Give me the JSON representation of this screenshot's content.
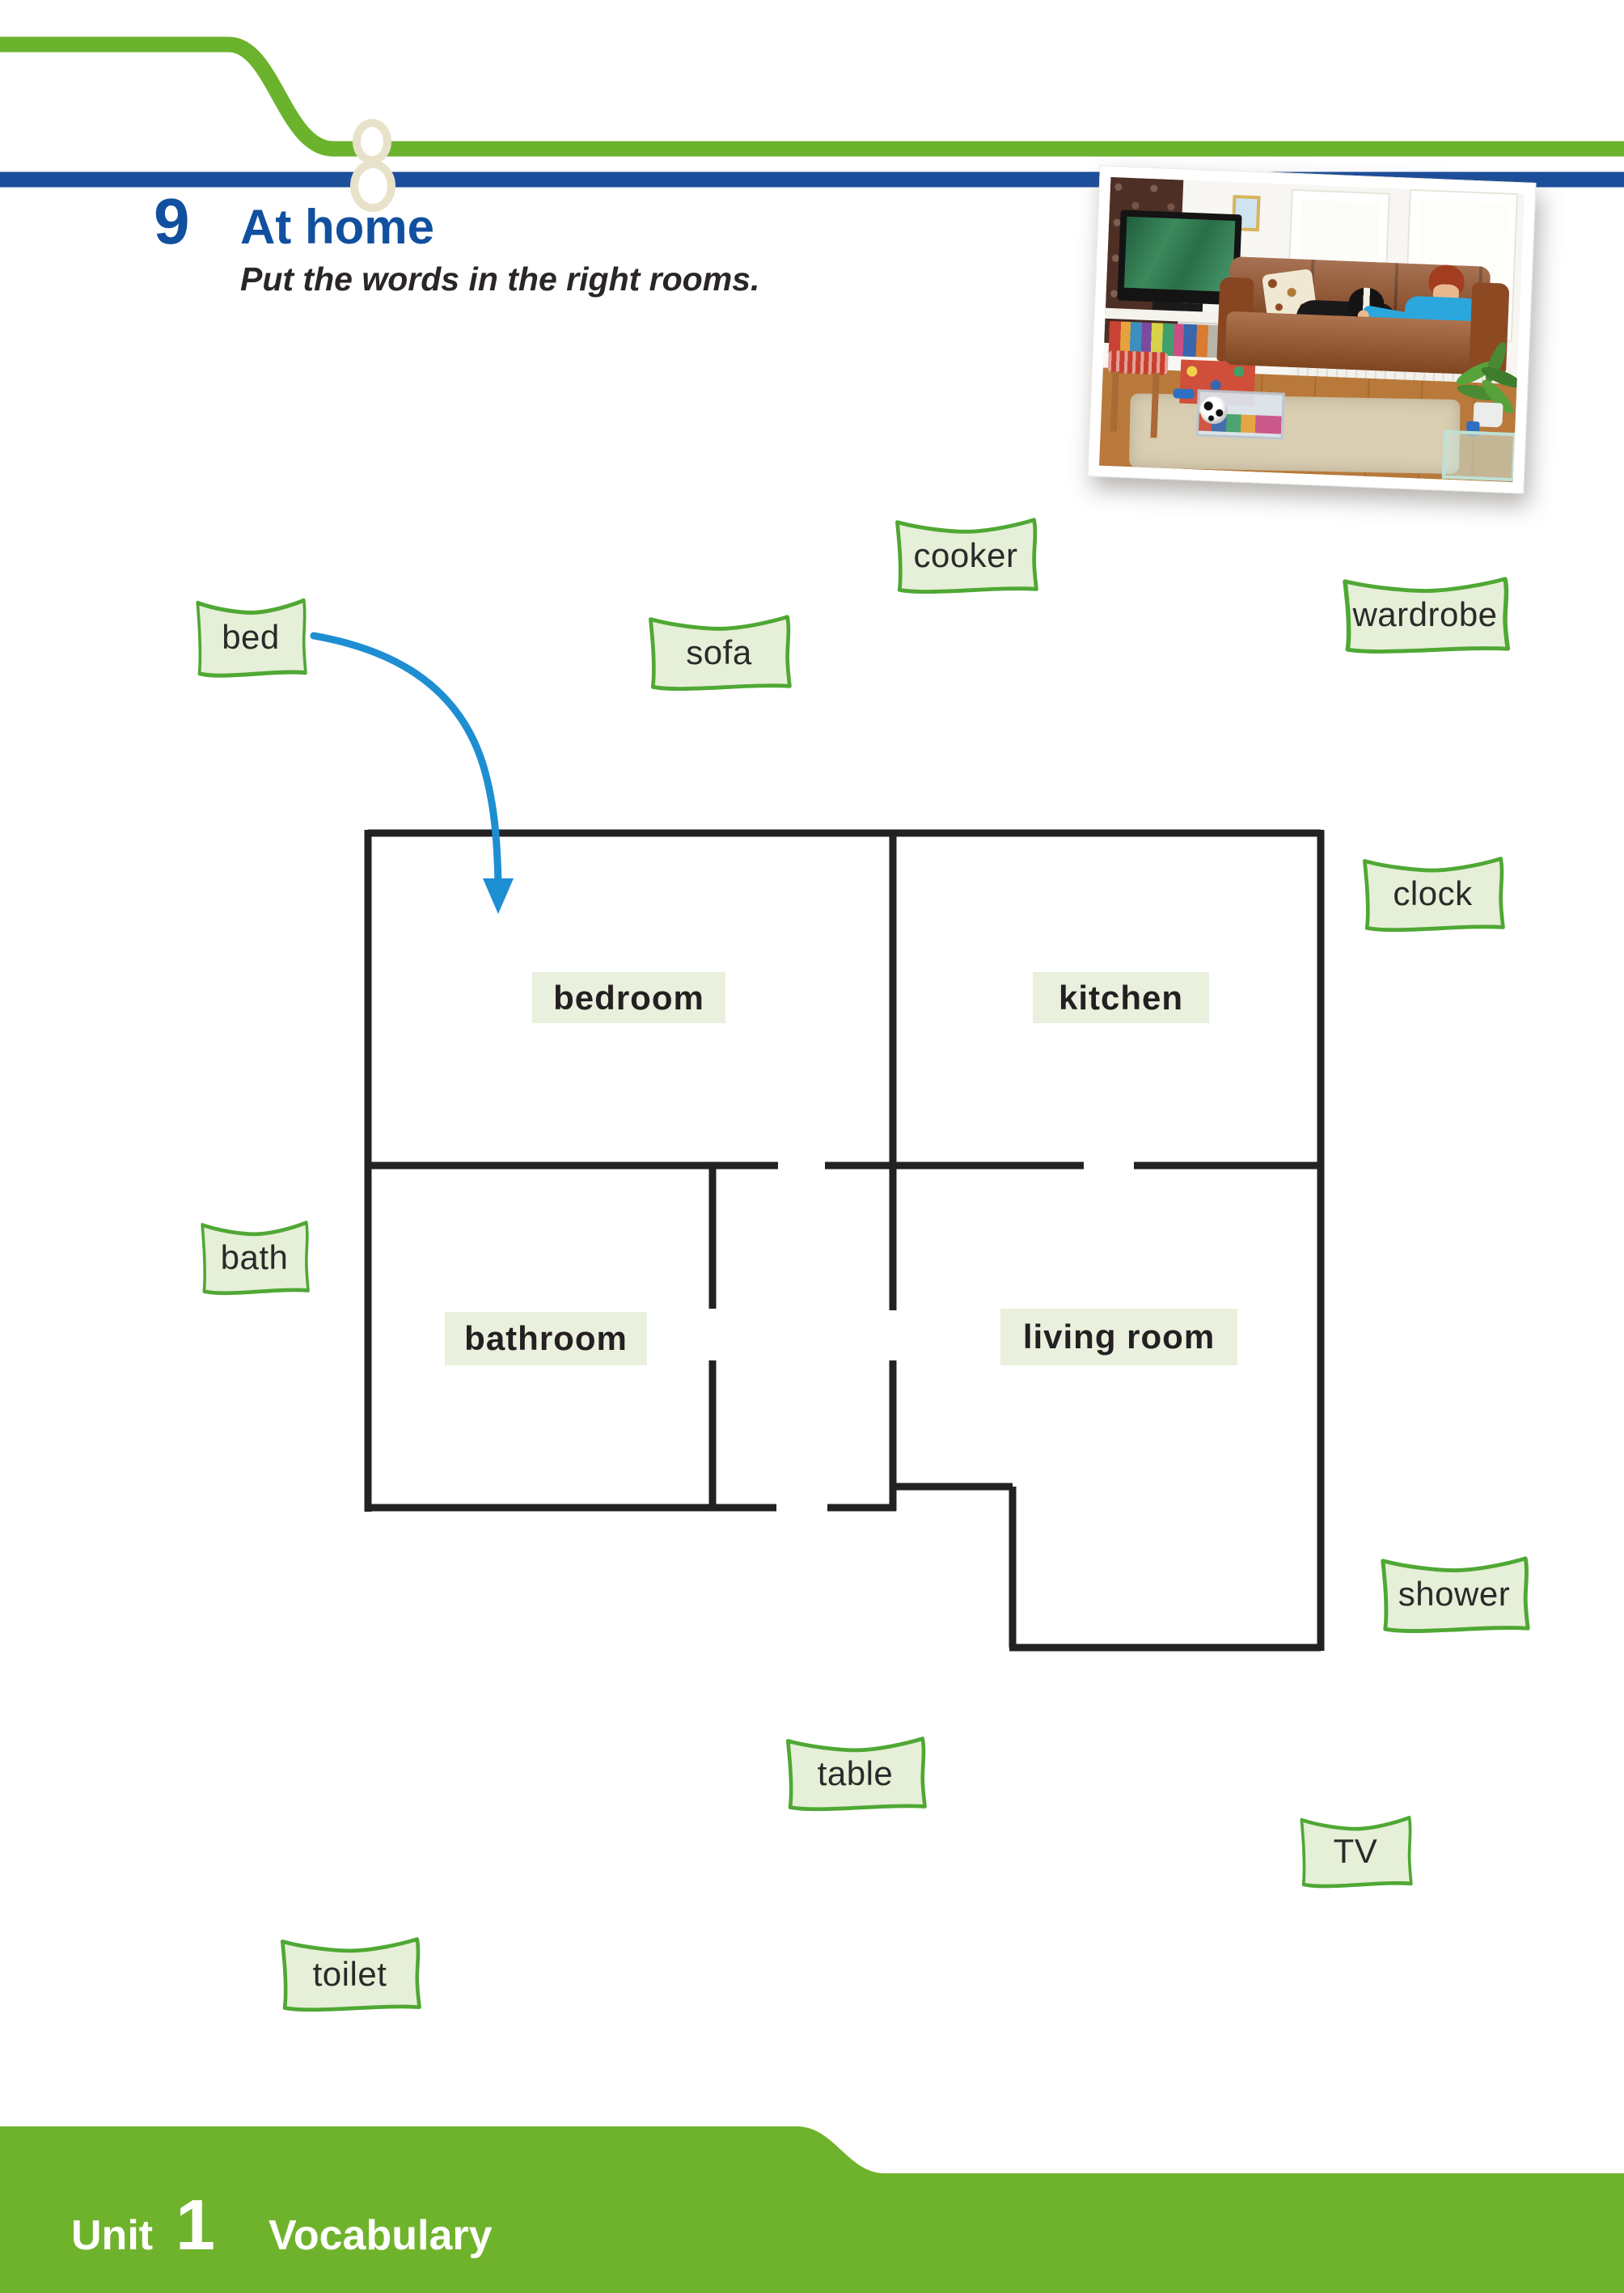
{
  "exercise": {
    "number": "9",
    "title": "At home",
    "instruction": "Put the words in the right rooms."
  },
  "photo": {
    "description": "Living room photo: boy in a blue T-shirt sitting on a brown leather sofa with a black and white dog, TV on the left, two windows, plant and glass table on the right, beige rug and football on a wooden floor"
  },
  "word_boxes": [
    {
      "label": "bed"
    },
    {
      "label": "sofa"
    },
    {
      "label": "cooker"
    },
    {
      "label": "wardrobe"
    },
    {
      "label": "clock"
    },
    {
      "label": "bath"
    },
    {
      "label": "shower"
    },
    {
      "label": "table"
    },
    {
      "label": "TV"
    },
    {
      "label": "toilet"
    }
  ],
  "floorplan": {
    "rooms": [
      {
        "label": "bedroom"
      },
      {
        "label": "kitchen"
      },
      {
        "label": "bathroom"
      },
      {
        "label": "living room"
      }
    ]
  },
  "footer": {
    "unit_label": "Unit",
    "unit_number": "1",
    "section": "Vocabulary"
  },
  "colors": {
    "header_green": "#6bb22d",
    "header_blue": "#1b4f9c",
    "title_blue": "#11509e",
    "box_border": "#4fa834",
    "box_fill": "#e6efd8",
    "room_label_fill": "#e9f0dd",
    "wall_line": "#242122",
    "arrow_blue": "#1e8ed3",
    "footer_green": "#6fb32c",
    "ornament_cream": "#e8e2ca"
  }
}
